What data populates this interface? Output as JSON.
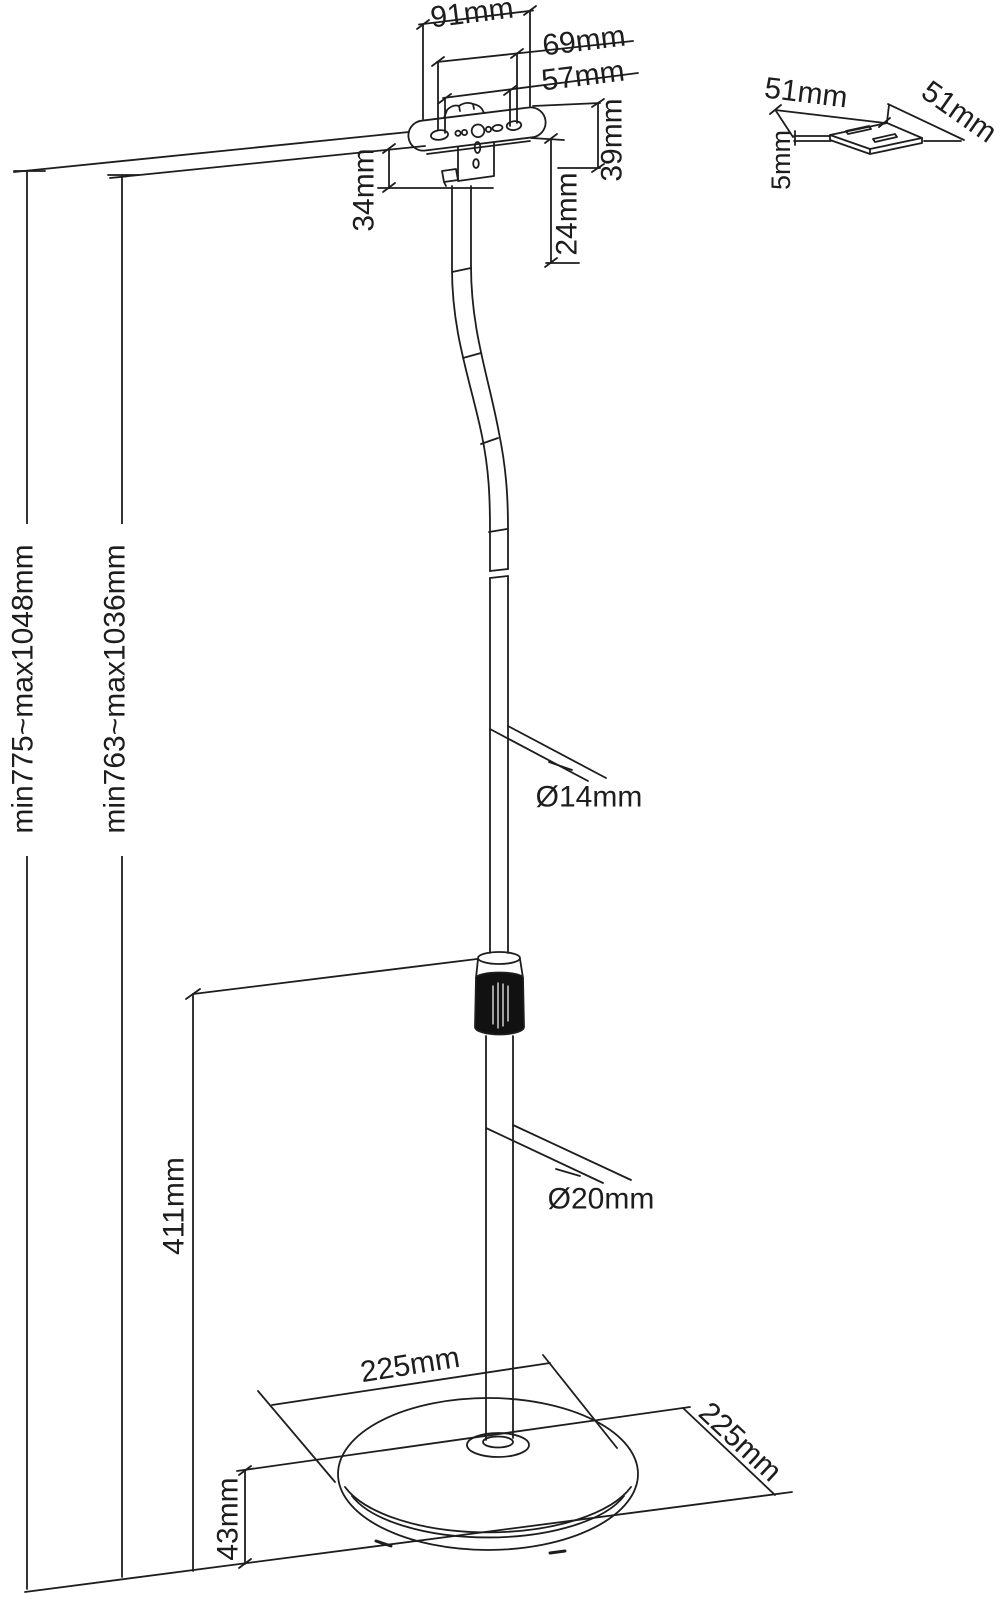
{
  "diagram": {
    "top_bracket_dims": {
      "width_outer": "91mm",
      "width_mid": "69mm",
      "width_inner": "57mm",
      "height_total": "39mm",
      "height_side": "34mm",
      "height_lower": "24mm"
    },
    "height_ranges": {
      "outer": "min775~max1048mm",
      "inner": "min763~max1036mm"
    },
    "poles": {
      "upper_diameter": "Ø14mm",
      "lower_diameter": "Ø20mm",
      "lower_section_height": "411mm"
    },
    "base": {
      "width": "225mm",
      "depth": "225mm",
      "height": "43mm"
    },
    "adapter_plate": {
      "width": "51mm",
      "depth": "51mm",
      "thickness": "5mm"
    },
    "colors": {
      "line": "#1d1d1d",
      "background": "#ffffff",
      "collar_fill": "#111111"
    }
  }
}
